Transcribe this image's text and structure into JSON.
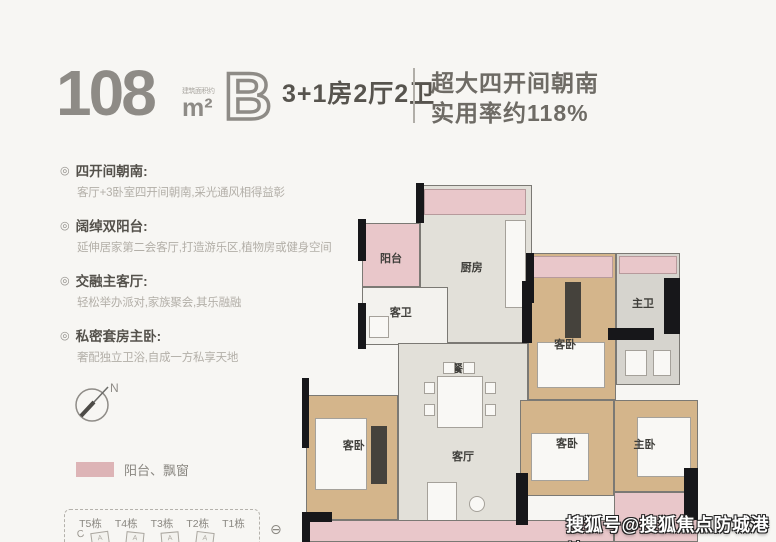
{
  "header": {
    "area_value": "108",
    "area_unit": "m²",
    "area_note": "建筑面积约",
    "plan_letter": "B",
    "layout": "3+1房2厅2卫",
    "highlight_line1": "超大四开间朝南",
    "highlight_line2": "实用率约118%"
  },
  "feature_bullet": "◎",
  "features": [
    {
      "title": "四开间朝南:",
      "desc": "客厅+3卧室四开间朝南,采光通风相得益彰"
    },
    {
      "title": "阔绰双阳台:",
      "desc": "延伸居家第二会客厅,打造游乐区,植物房或健身空间"
    },
    {
      "title": "交融主客厅:",
      "desc": "轻松举办派对,家族聚会,其乐融融"
    },
    {
      "title": "私密套房主卧:",
      "desc": "奢配独立卫浴,自成一方私享天地"
    }
  ],
  "compass": {
    "label": "N"
  },
  "legend": {
    "label": "阳台、飘窗",
    "swatch_color": "#ddb4b6"
  },
  "towers": {
    "items": [
      "T5栋",
      "T4栋",
      "T3栋",
      "T2栋",
      "T1栋"
    ],
    "marker": "C",
    "shape_letters": [
      "A",
      "A",
      "A",
      "A"
    ],
    "crossed_circle_icon": "⊖"
  },
  "floorplan": {
    "rooms": {
      "balcony": {
        "label": "阳台"
      },
      "kitchen": {
        "label": "厨房"
      },
      "guest_bath": {
        "label": "客卫"
      },
      "dining": {
        "label": "餐厅"
      },
      "bedroom_top_right": {
        "label": "客卧"
      },
      "master_bath": {
        "label": "主卫"
      },
      "bedroom_left": {
        "label": "客卧"
      },
      "living": {
        "label": "客厅"
      },
      "bedroom_mid": {
        "label": "客卧"
      },
      "master_bedroom": {
        "label": "主卧"
      }
    },
    "colors": {
      "balcony_pink": "#e9c7ca",
      "bedroom_tan": "#d4b58b",
      "wall_black": "#17171a"
    }
  },
  "watermark": "搜狐号@搜狐焦点防城港站"
}
